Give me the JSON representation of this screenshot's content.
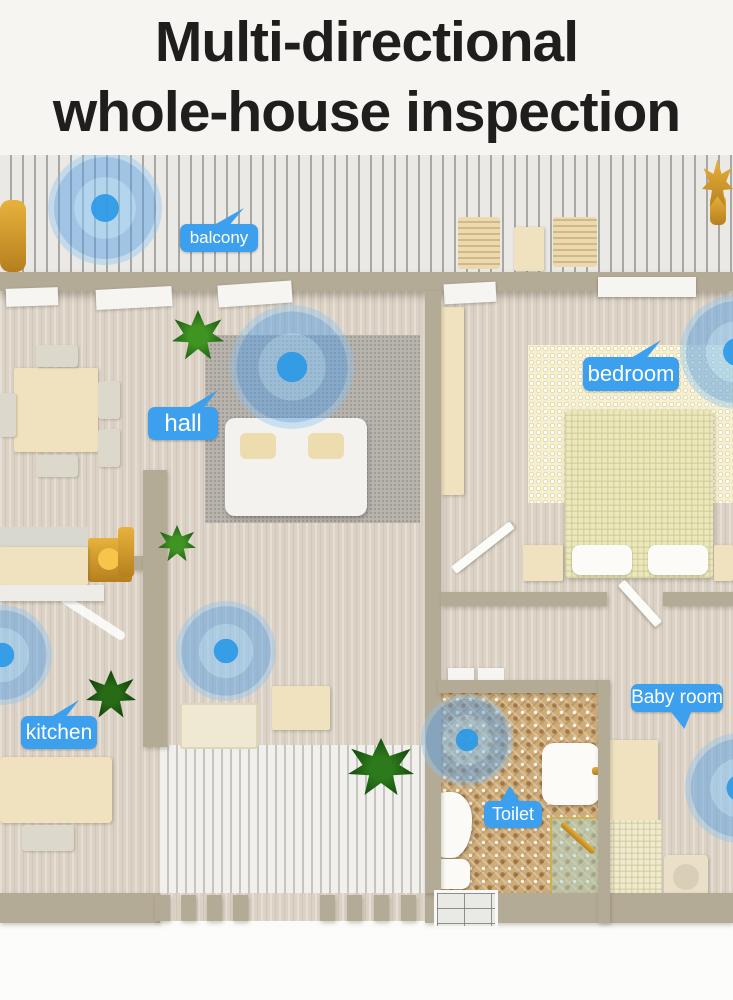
{
  "title": {
    "line1": "Multi-directional",
    "line2": "whole-house inspection"
  },
  "room_labels": {
    "balcony": "balcony",
    "hall": "hall",
    "bedroom": "bedroom",
    "kitchen": "kitchen",
    "baby_room": "Baby room",
    "toilet": "Toilet"
  },
  "detection_zones": [
    "balcony",
    "hall",
    "kitchen",
    "corridor",
    "bedroom",
    "baby room",
    "toilet"
  ],
  "colors": {
    "label_bubble_blue": "#3da0ee",
    "radar_core_blue": "#2d9ae8",
    "radar_ring_blue": "#8bc2f0",
    "title_text": "#201d1d",
    "wall_tan": "#b4ab96",
    "floor_beige": "#dbd2c5"
  }
}
